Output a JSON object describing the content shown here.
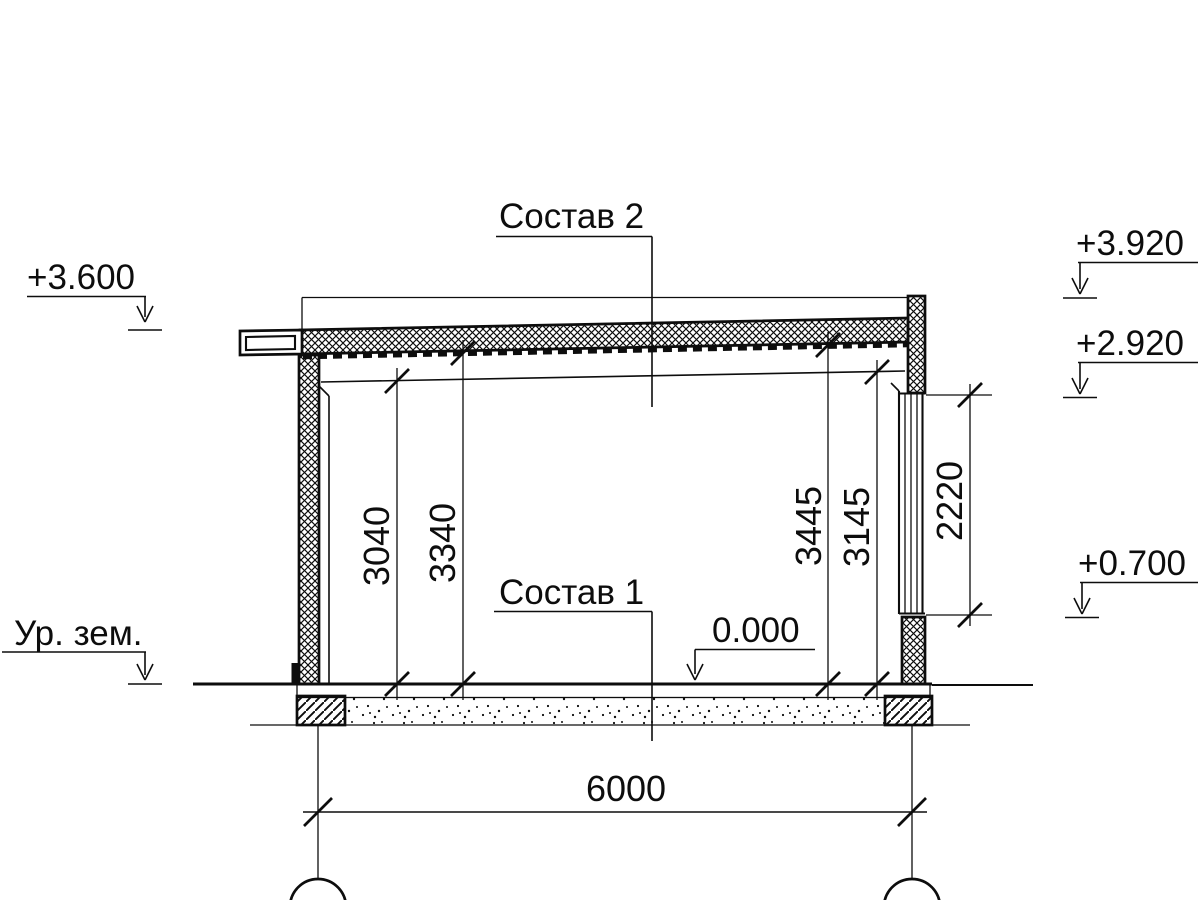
{
  "drawing": {
    "kind": "building-cross-section",
    "labels": {
      "composition2": "Состав 2",
      "composition1": "Состав 1",
      "ground_level": "Ур. зем."
    },
    "elevations": {
      "roof_eave": "+3.600",
      "parapet_top": "+3.920",
      "window_head": "+2.920",
      "window_sill": "+0.700",
      "floor": "0.000"
    },
    "dimensions": {
      "span": "6000",
      "clear_height_left": "3040",
      "deck_height_left": "3340",
      "deck_height_right": "3445",
      "clear_height_right": "3145",
      "window_height": "2220"
    },
    "colors": {
      "line": "#0d0d0d",
      "background": "#ffffff"
    }
  }
}
